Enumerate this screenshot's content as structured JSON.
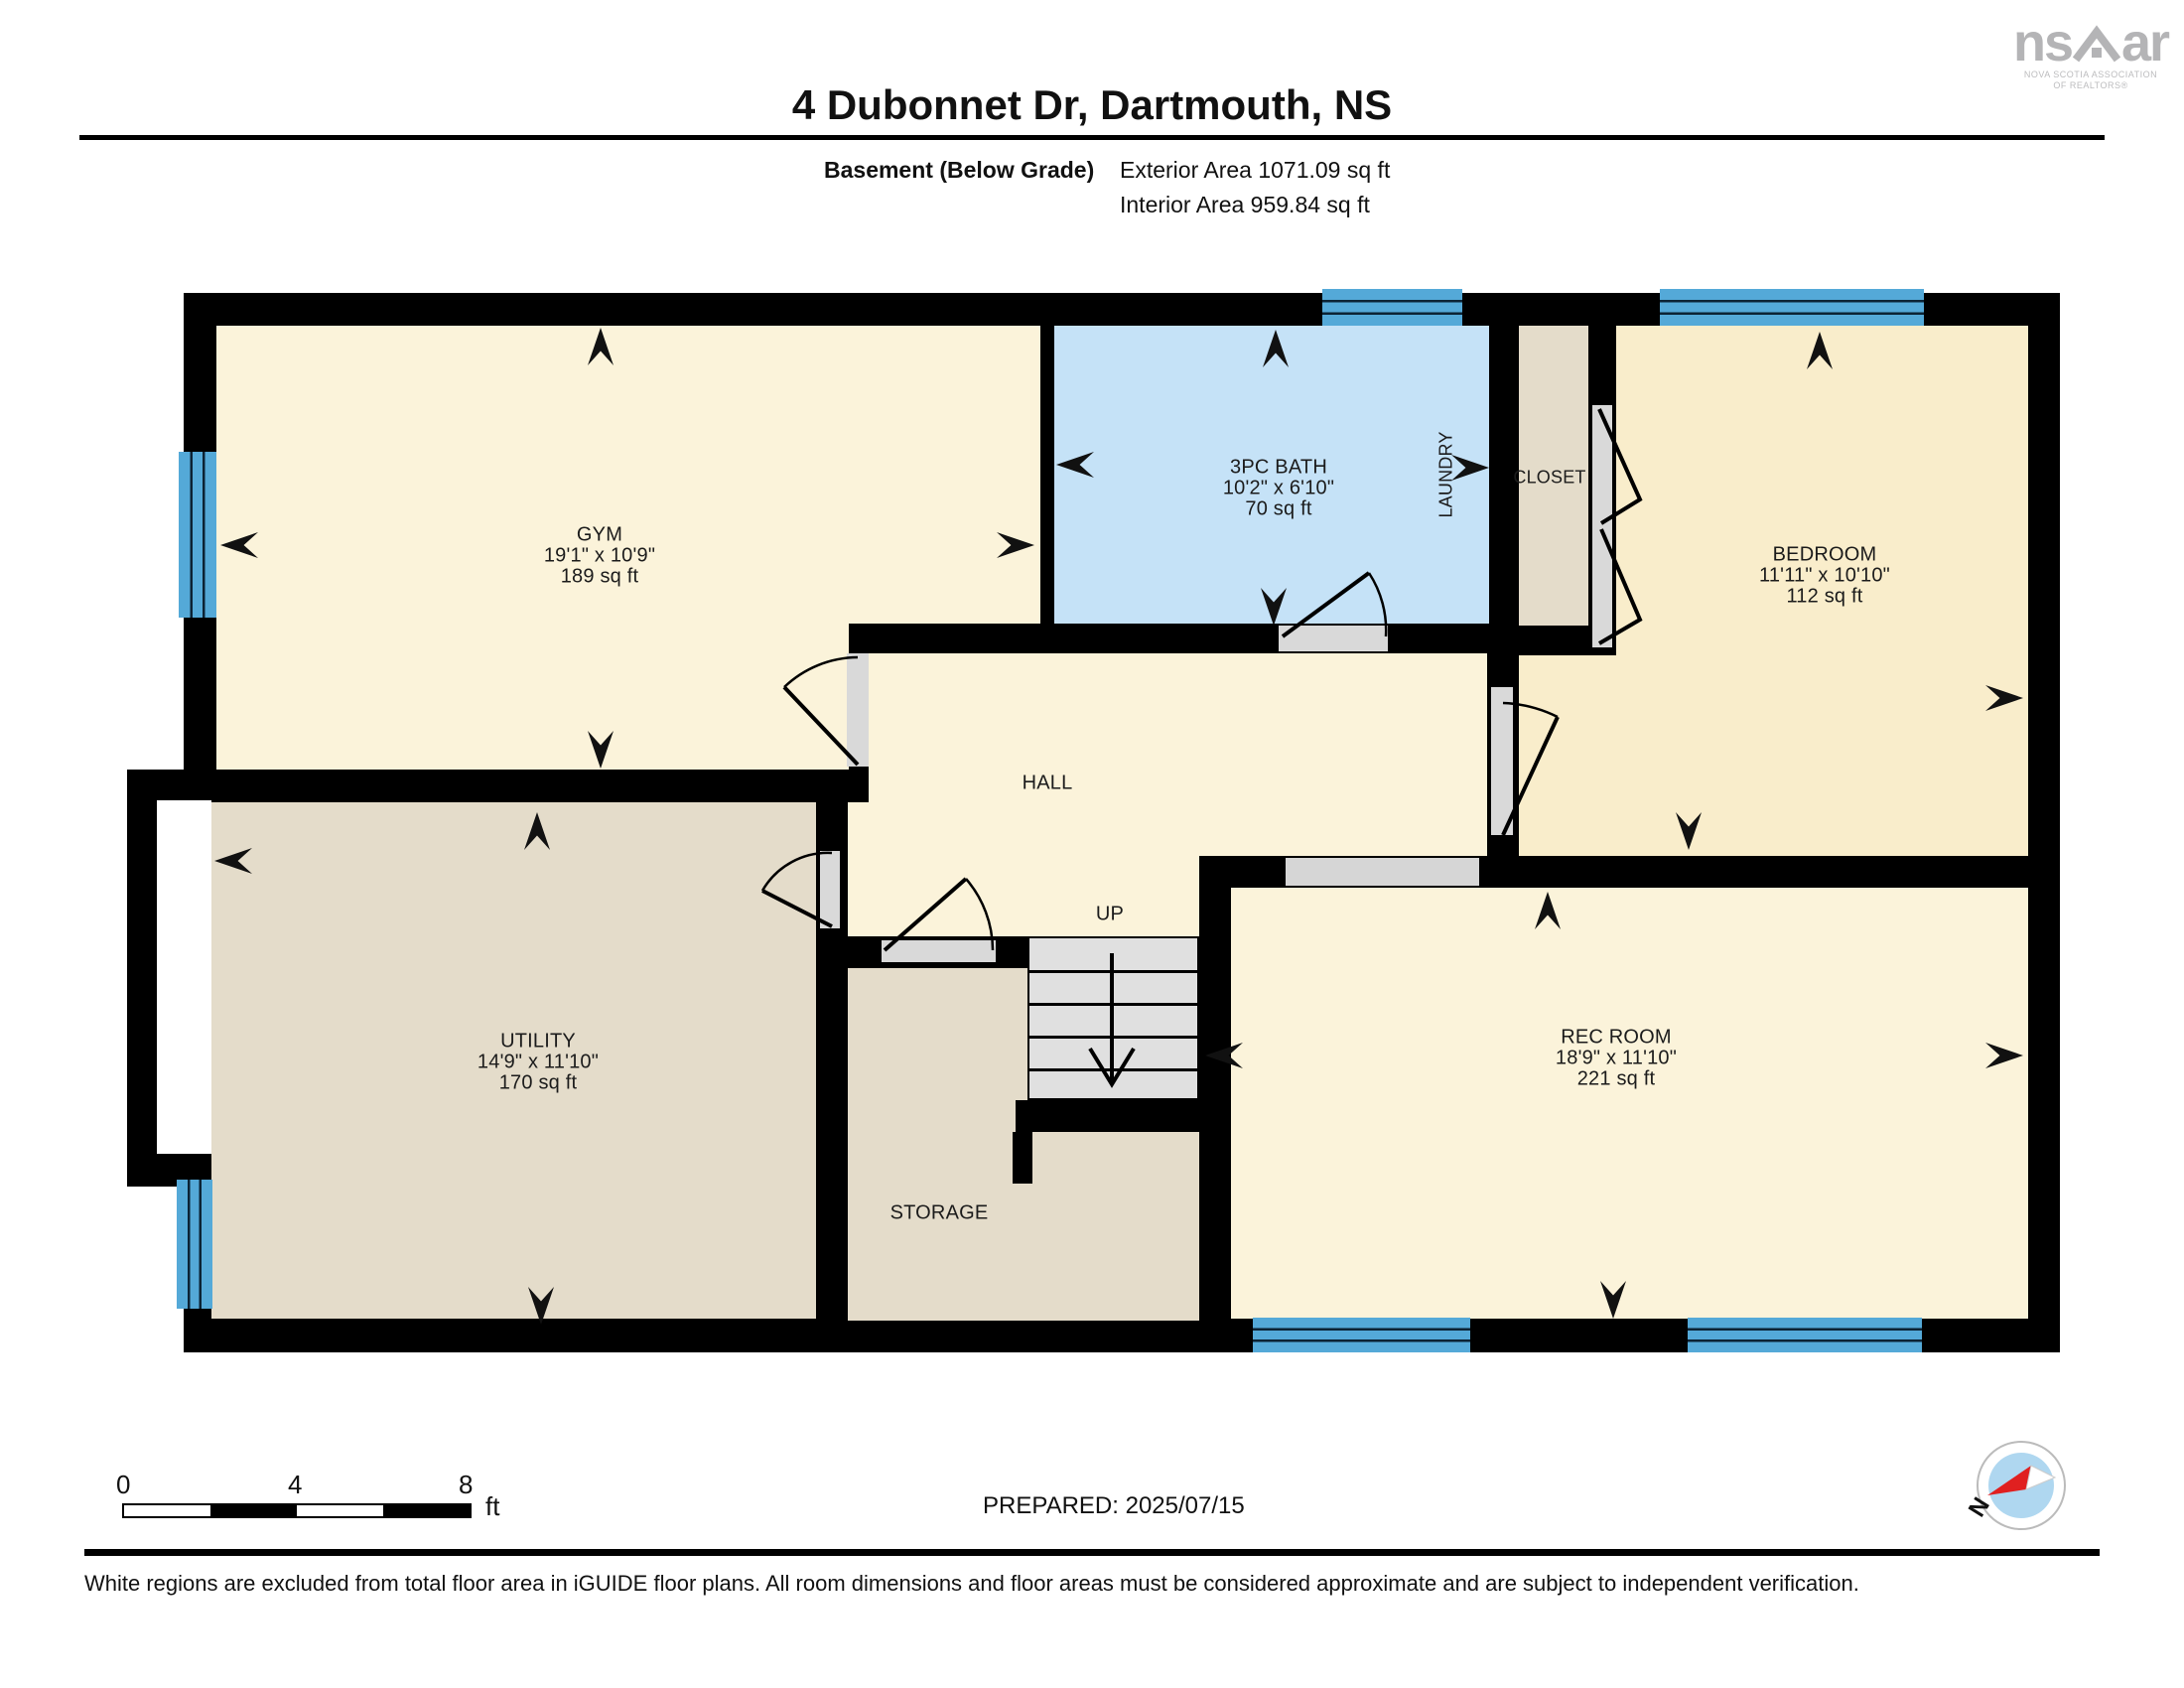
{
  "header": {
    "title": "4 Dubonnet Dr, Dartmouth, NS",
    "floor_label": "Basement (Below Grade)",
    "exterior_area": "Exterior Area 1071.09 sq ft",
    "interior_area": "Interior Area 959.84 sq ft"
  },
  "logo": {
    "name_left": "ns",
    "name_right": "ar",
    "caption_line1": "NOVA SCOTIA ASSOCIATION",
    "caption_line2": "OF REALTORS®"
  },
  "rooms": {
    "gym": {
      "name": "GYM",
      "dims": "19'1\" x 10'9\"",
      "area": "189 sq ft"
    },
    "bath": {
      "name": "3PC BATH",
      "dims": "10'2\" x 6'10\"",
      "area": "70 sq ft"
    },
    "laundry": {
      "name": "LAUNDRY"
    },
    "closet": {
      "name": "CLOSET"
    },
    "bedroom": {
      "name": "BEDROOM",
      "dims": "11'11\" x 10'10\"",
      "area": "112 sq ft"
    },
    "hall": {
      "name": "HALL"
    },
    "stairs": {
      "label": "UP"
    },
    "utility": {
      "name": "UTILITY",
      "dims": "14'9\" x 11'10\"",
      "area": "170 sq ft"
    },
    "storage": {
      "name": "STORAGE"
    },
    "rec": {
      "name": "REC ROOM",
      "dims": "18'9\" x 11'10\"",
      "area": "221 sq ft"
    }
  },
  "scale_bar": {
    "tick_0": "0",
    "tick_4": "4",
    "tick_8": "8",
    "unit": "ft"
  },
  "compass": {
    "north_label": "N"
  },
  "footer": {
    "prepared": "PREPARED: 2025/07/15",
    "disclaimer": "White regions are excluded from total floor area in iGUIDE floor plans. All room dimensions and floor areas must be considered approximate and are subject to independent verification."
  },
  "colors": {
    "wall": "#000000",
    "floor_cream": "#FBF3DA",
    "floor_bedroom": "#F9EDCB",
    "floor_beige": "#E4DCCA",
    "bathroom_blue": "#C5E2F7",
    "window_blue": "#54A9D8",
    "stairs_gray": "#E0E0E0",
    "compass_red": "#E02020",
    "logo_gray": "#B4B4B6"
  }
}
